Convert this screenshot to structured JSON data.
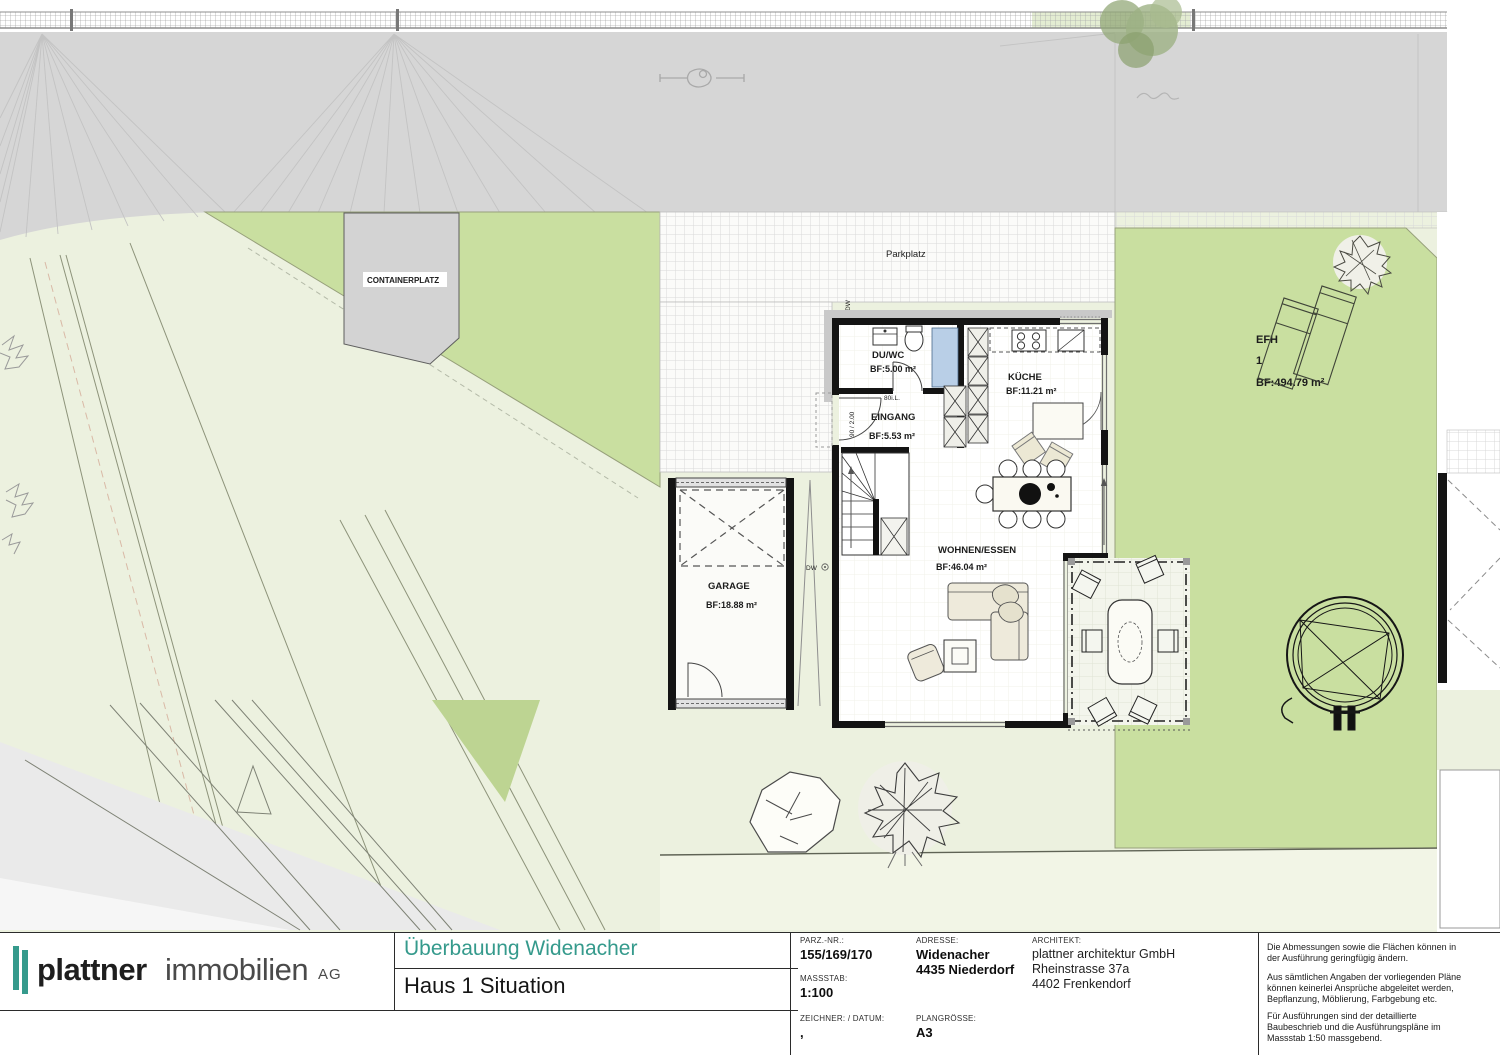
{
  "colors": {
    "brand_teal": "#359a8c",
    "road_gray": "#d6d6d6",
    "lawn_green": "#c9dfa0",
    "pale_green": "#ecf1df",
    "shower_blue": "#b9cfe7"
  },
  "plan": {
    "labels": {
      "containerplatz": "CONTAINERPLATZ",
      "parkplatz": "Parkplatz",
      "dw_top": "DW",
      "dw_side": "DW",
      "door_clear_width": "80i.L.",
      "door_size": "90 / 2.00"
    },
    "rooms": {
      "duwc": {
        "name": "DU/WC",
        "area": "BF:5.00 m²"
      },
      "eingang": {
        "name": "EINGANG",
        "area": "BF:5.53 m²"
      },
      "kueche": {
        "name": "KÜCHE",
        "area": "BF:11.21 m²"
      },
      "wohnen": {
        "name": "WOHNEN/ESSEN",
        "area": "BF:46.04 m²"
      },
      "garage": {
        "name": "GARAGE",
        "area": "BF:18.88 m²"
      }
    },
    "parcel": {
      "line1": "EFH",
      "line2": "1",
      "line3": "BF:494.79 m²"
    }
  },
  "titleblock": {
    "logo": {
      "word1": "plattner",
      "word2": "immobilien",
      "word3": "AG"
    },
    "project_title": "Überbauung Widenacher",
    "sheet_title": "Haus 1 Situation",
    "fields": {
      "parz_label": "PARZ.-NR.:",
      "parz_value": "155/169/170",
      "massstab_label": "MASSSTAB:",
      "massstab_value": "1:100",
      "zeichner_label": "ZEICHNER: / DATUM:",
      "zeichner_value": ",",
      "adresse_label": "ADRESSE:",
      "adresse_value1": "Widenacher",
      "adresse_value2": "4435 Niederdorf",
      "plangroesse_label": "PLANGRÖSSE:",
      "plangroesse_value": "A3",
      "architekt_label": "ARCHITEKT:",
      "architekt_value1": "plattner architektur GmbH",
      "architekt_value2": "Rheinstrasse 37a",
      "architekt_value3": "4402 Frenkendorf"
    },
    "notes": {
      "note1": "Die Abmessungen sowie die Flächen können in der Ausführung geringfügig ändern.",
      "note2": "Aus sämtlichen Angaben der vorliegenden Pläne können keinerlei Ansprüche abgeleitet werden, Bepflanzung, Möblierung, Farbgebung etc.",
      "note3": "Für Ausführungen sind der detaillierte Baubeschrieb und die Ausführungspläne im Massstab 1:50 massgebend."
    }
  }
}
